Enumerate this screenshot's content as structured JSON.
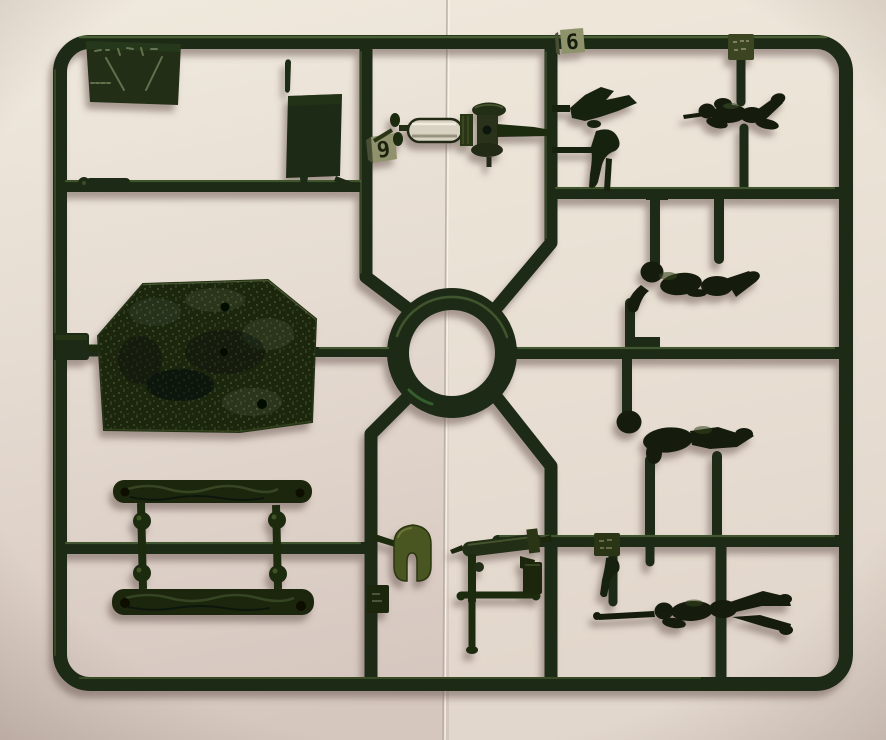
{
  "meta": {
    "description": "Photograph of a dark green injection-moulded plastic model kit sprue (military figures and machine-gun accessories) lying on light paper",
    "image_type": "photograph"
  },
  "palette": {
    "background_top": "#efe9dc",
    "background_bottom": "#d5c7bf",
    "background_left": "#e4d9d4",
    "seam_line": "#b9ad a6",
    "plastic_dark": "#1b2a12",
    "plastic_part": "#141d0b",
    "plastic_highlight": "#8fae6a",
    "shield_olive": "#4a5624",
    "jacket_bright": "#d8d2c2",
    "tag_face": "#90926e",
    "shadow": "#7a6a62"
  },
  "sprue": {
    "material": "dark green polystyrene",
    "part_tags": [
      {
        "id": "tag-9",
        "label": "9"
      },
      {
        "id": "tag-6",
        "label": "6"
      },
      {
        "id": "tag-top-right",
        "label": ""
      },
      {
        "id": "tag-bottom-right",
        "label": ""
      },
      {
        "id": "tag-below-shield",
        "label": ""
      }
    ],
    "parts": [
      "manufacturer-logo-plate",
      "flat-hatch-panel",
      "locating-pin",
      "small-strip-part",
      "water-cooled-machine-gun-with-mount",
      "crew-arm-parts",
      "prone-rifleman-top-right",
      "kneeling-soldier",
      "advancing-soldier",
      "prone-rifleman-bottom-right",
      "textured-terrain-base",
      "small-side-block",
      "log-beam-upper",
      "log-beam-lower",
      "suspension-link-left",
      "suspension-link-right",
      "gun-shield",
      "machine-gun-on-tripod",
      "ammo-box",
      "center-ring-runner"
    ]
  }
}
